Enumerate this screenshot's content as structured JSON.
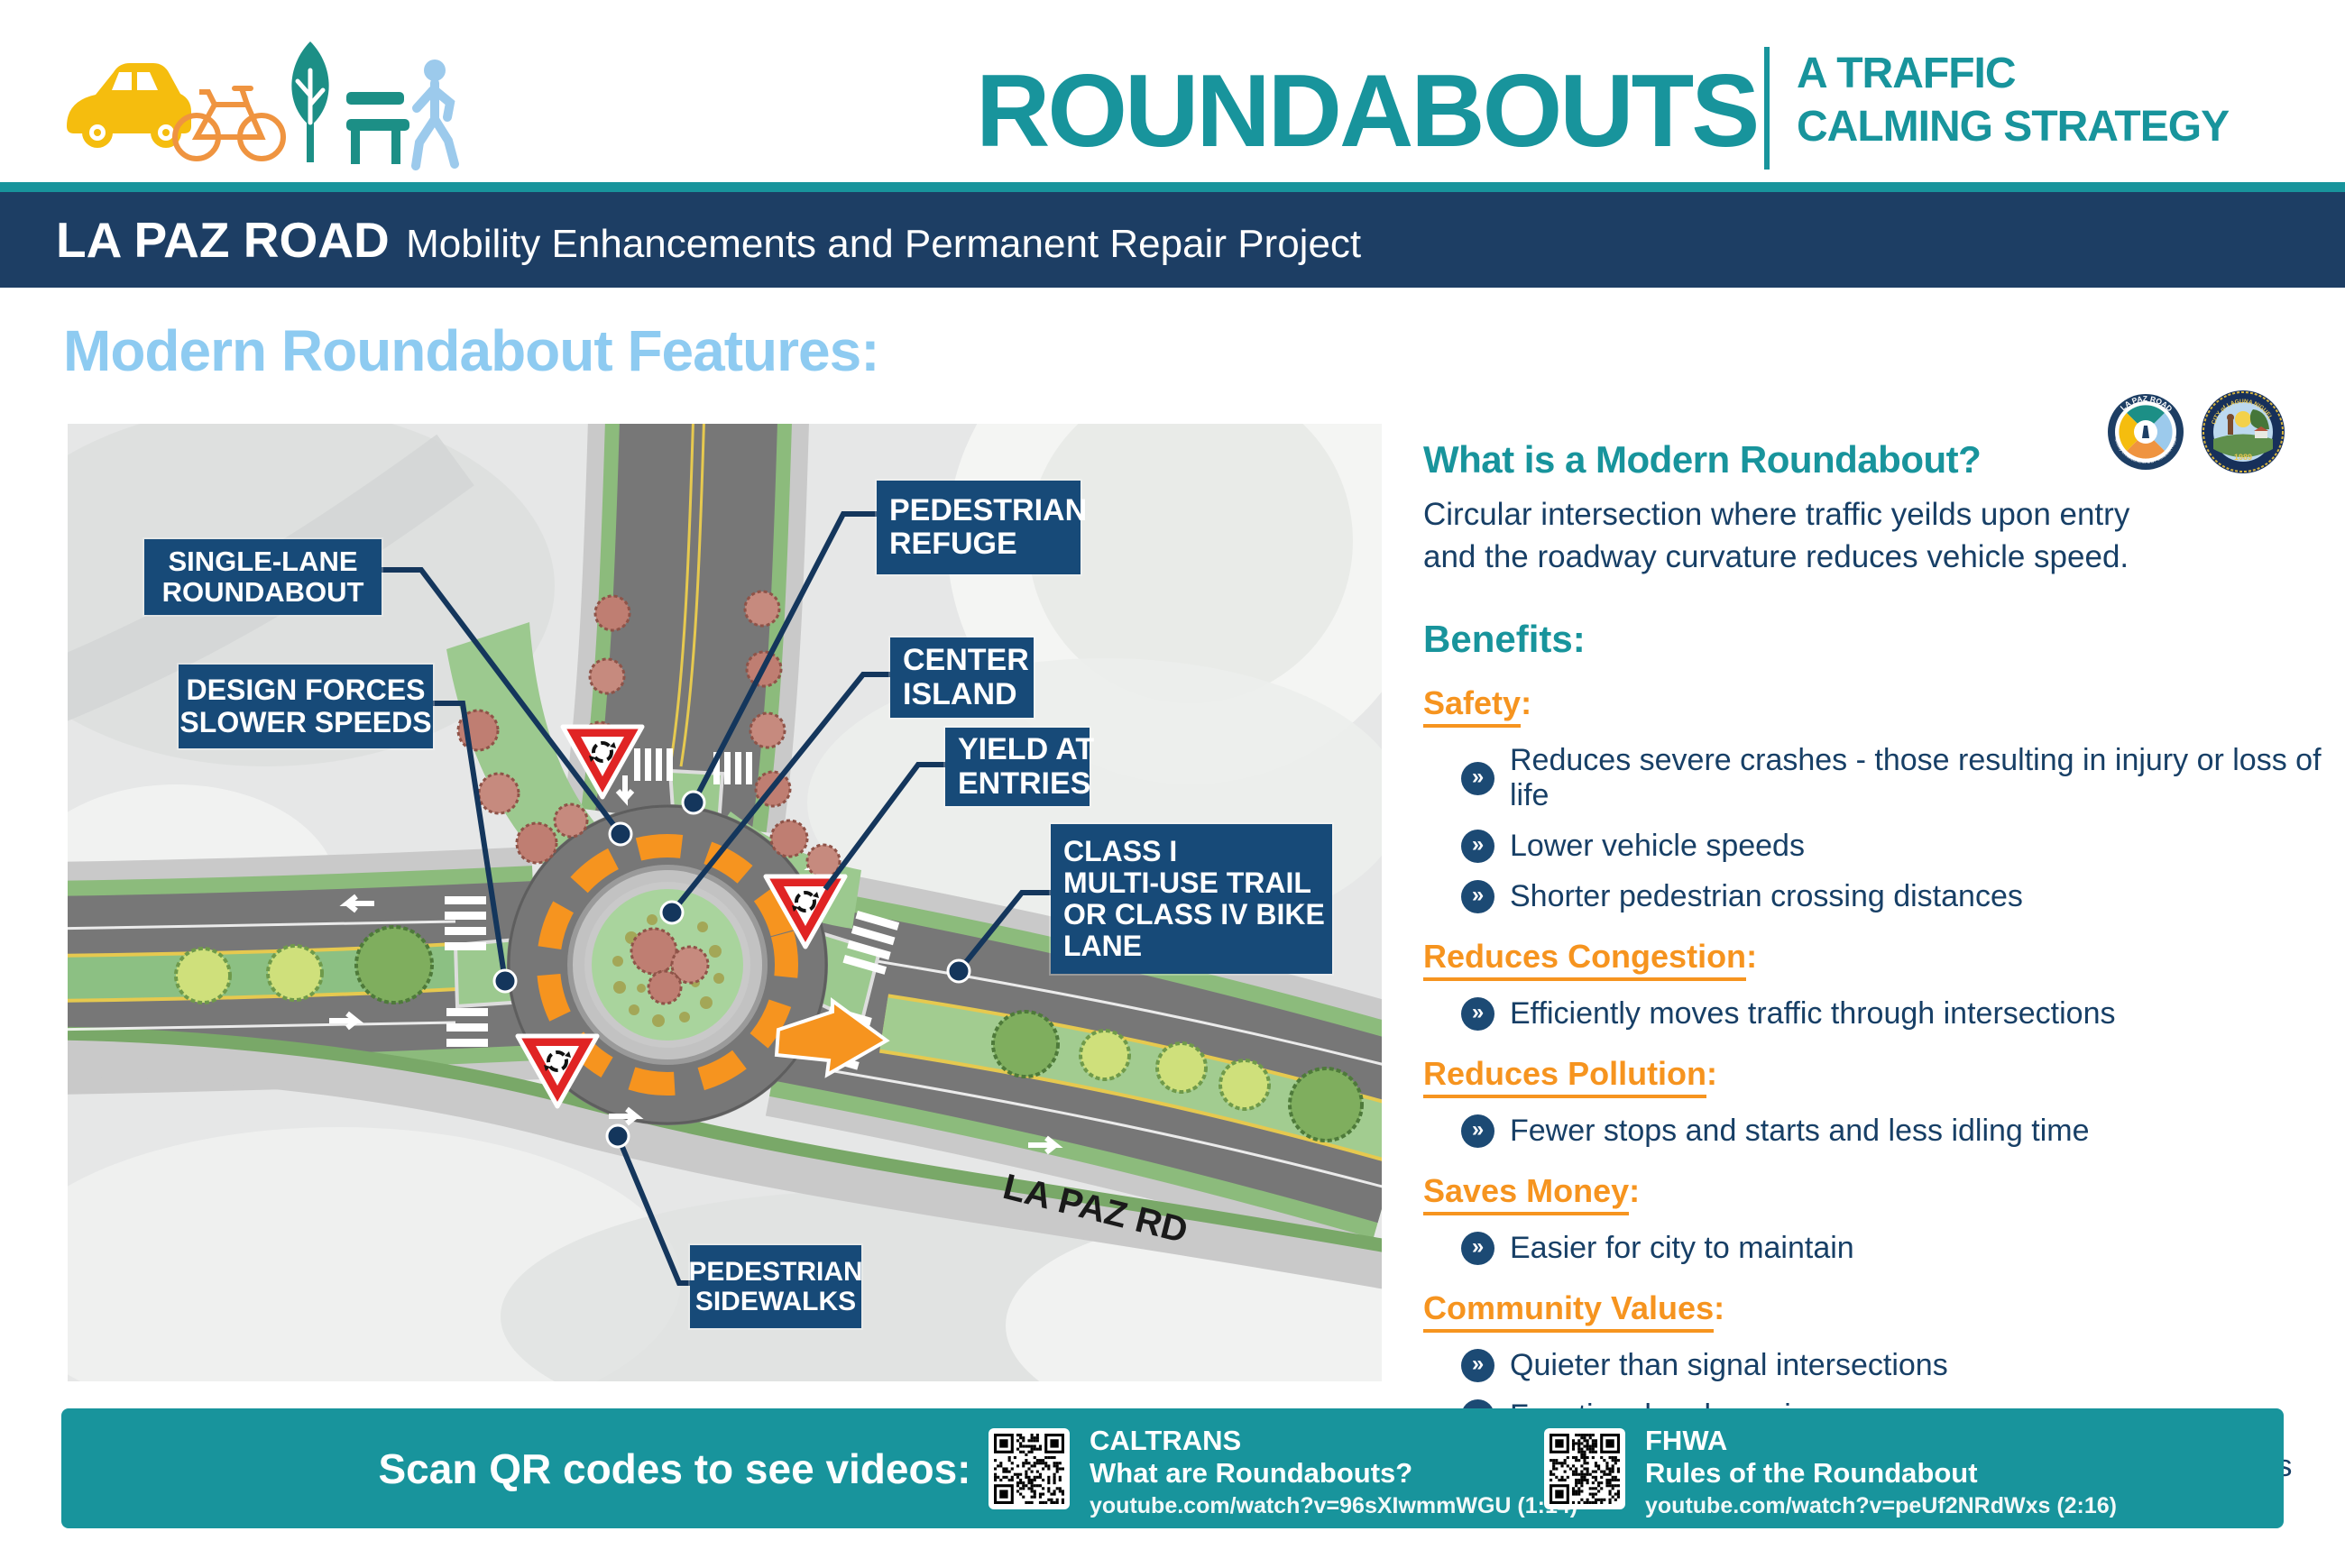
{
  "header": {
    "title": "ROUNDABOUTS",
    "subtitle_line1": "A TRAFFIC",
    "subtitle_line2": "CALMING STRATEGY",
    "banner_title": "LA PAZ ROAD",
    "banner_subtitle": "Mobility Enhancements and Permanent Repair Project",
    "project_logo": {
      "ring_text_top": "LA PAZ ROAD",
      "ring_text_bottom": "Mobility Enhancements and Permanent Repair"
    },
    "city_seal": {
      "ring_text": "CITY of LAGUNA NIGUEL",
      "year": "1989"
    }
  },
  "section": {
    "heading": "Modern Roundabout Features:"
  },
  "map": {
    "road_label": "LA PAZ RD",
    "callouts": [
      {
        "id": "single-lane-roundabout",
        "lines": [
          "SINGLE-LANE",
          "ROUNDABOUT"
        ]
      },
      {
        "id": "design-forces-slower-speeds",
        "lines": [
          "DESIGN FORCES",
          "SLOWER SPEEDS"
        ]
      },
      {
        "id": "pedestrian-refuge",
        "lines": [
          "PEDESTRIAN",
          "REFUGE"
        ]
      },
      {
        "id": "center-island",
        "lines": [
          "CENTER",
          "ISLAND"
        ]
      },
      {
        "id": "yield-at-entries",
        "lines": [
          "YIELD AT",
          "ENTRIES"
        ]
      },
      {
        "id": "class-i-trail",
        "lines": [
          "CLASS I",
          "MULTI-USE TRAIL",
          "OR CLASS IV BIKE",
          "LANE"
        ]
      },
      {
        "id": "pedestrian-sidewalks",
        "lines": [
          "PEDESTRIAN",
          "SIDEWALKS"
        ]
      }
    ]
  },
  "info": {
    "question_heading": "What is a Modern Roundabout?",
    "question_body_line1": "Circular intersection where traffic yeilds upon entry",
    "question_body_line2": "and the roadway curvature reduces vehicle speed.",
    "benefits_heading": "Benefits:",
    "benefit_groups": [
      {
        "title": "Safety",
        "items": [
          "Reduces severe crashes - those resulting in injury or loss of life",
          "Lower vehicle speeds",
          "Shorter pedestrian crossing distances"
        ]
      },
      {
        "title": "Reduces Congestion",
        "items": [
          "Efficiently moves traffic through intersections"
        ]
      },
      {
        "title": "Reduces Pollution",
        "items": [
          "Fewer stops and starts and less idling time"
        ]
      },
      {
        "title": "Saves Money",
        "items": [
          "Easier for city to maintain"
        ]
      },
      {
        "title": "Community Values",
        "items": [
          "Quieter than signal intersections",
          "Functional and scenic",
          "Features for all users: vehicles, pedestrians and bicyclists"
        ]
      }
    ]
  },
  "footer": {
    "scan_text": "Scan QR codes to see videos:",
    "videos": [
      {
        "org": "CALTRANS",
        "title": "What are Roundabouts?",
        "url": "youtube.com/watch?v=96sXIwmmWGU (1:14)"
      },
      {
        "org": "FHWA",
        "title": "Rules of the Roundabout",
        "url": "youtube.com/watch?v=peUf2NRdWxs (2:16)"
      }
    ]
  },
  "colors": {
    "teal": "#18949c",
    "navy_banner": "#1d3e64",
    "label_navy": "#174a78",
    "text_navy": "#173f66",
    "orange": "#f6941f",
    "light_blue_heading": "#8ecbf1"
  }
}
